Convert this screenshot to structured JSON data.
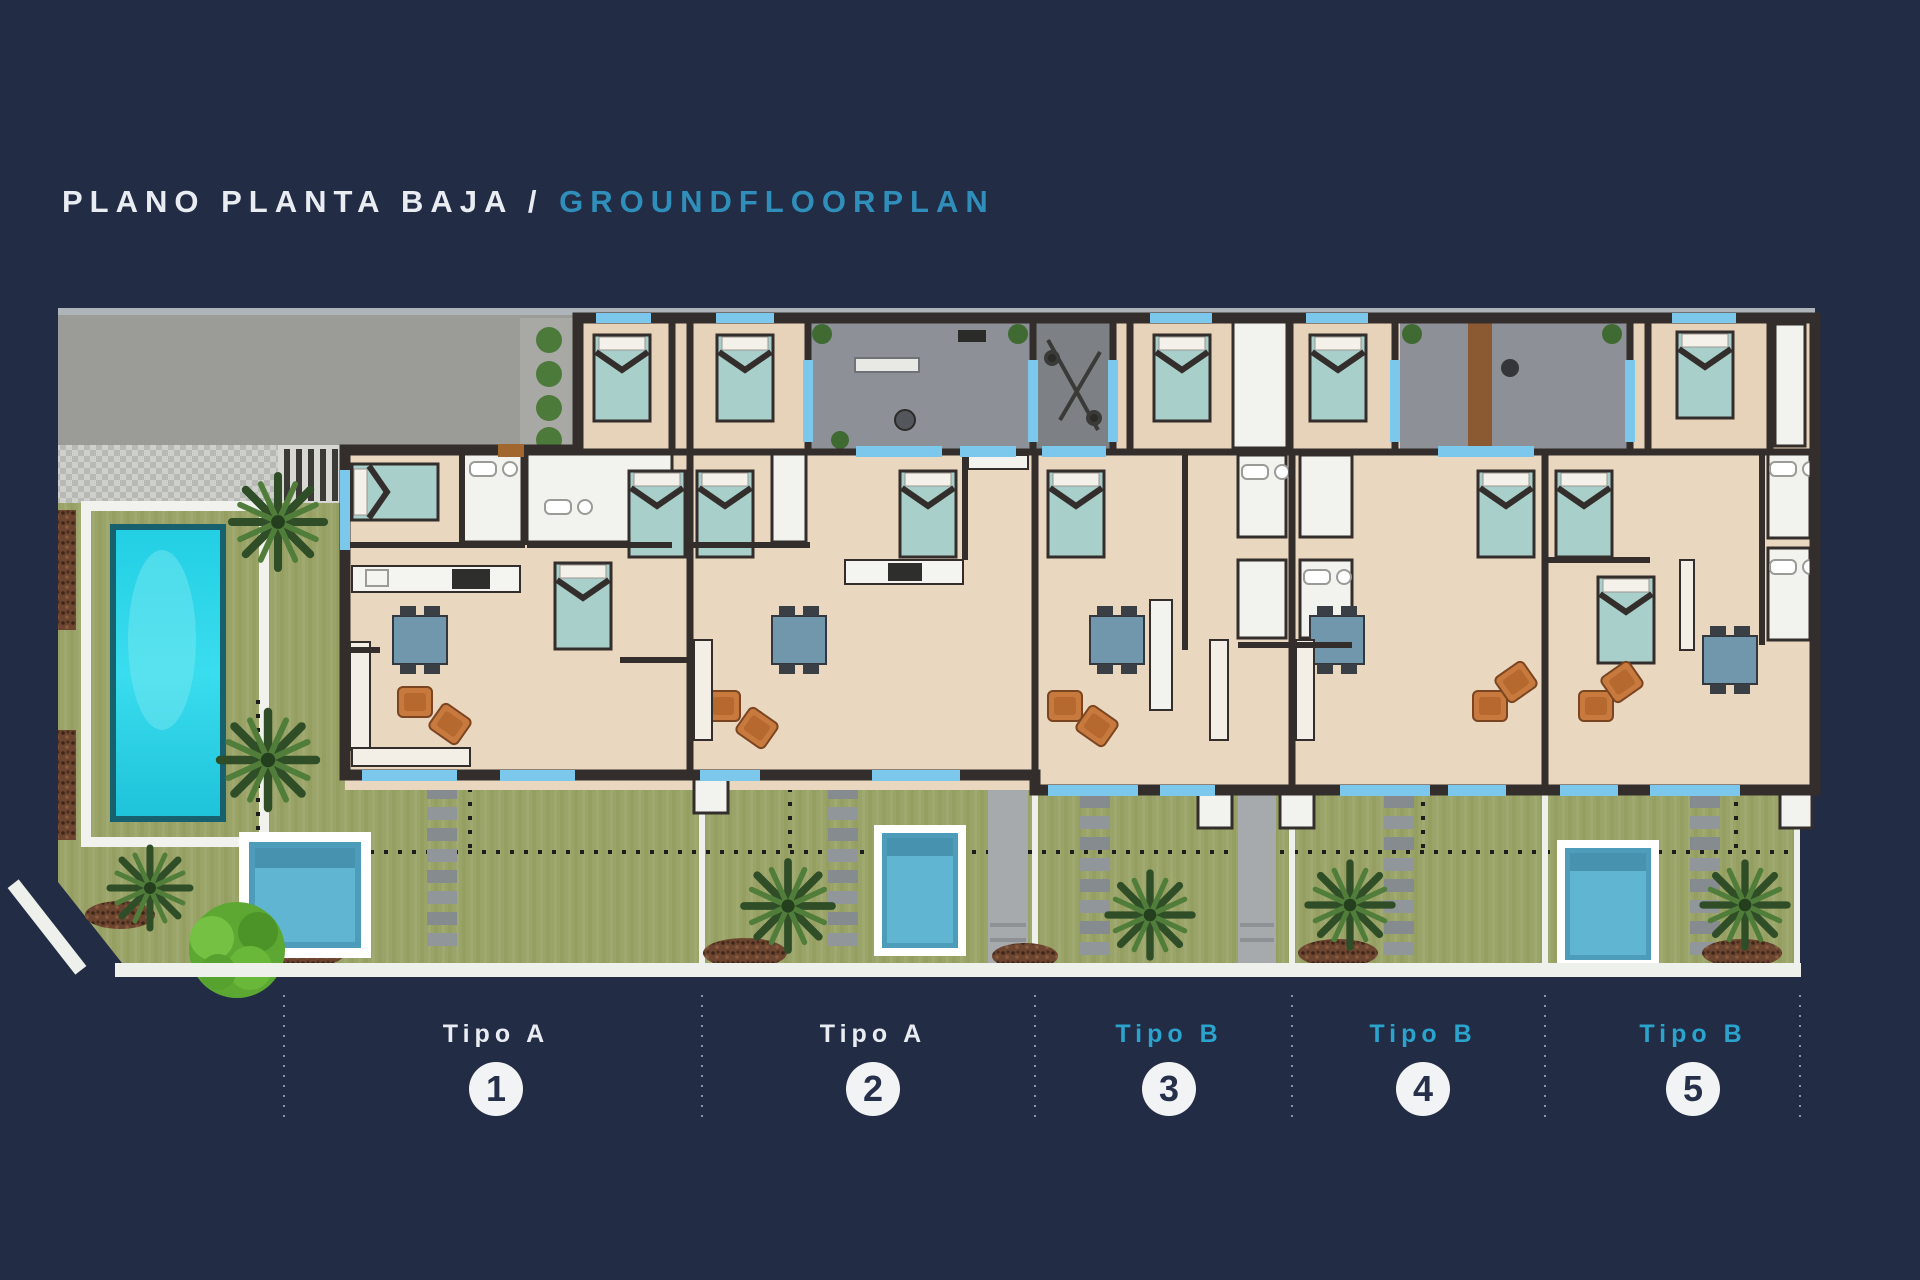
{
  "title": {
    "spanish": "PLANO PLANTA  BAJA",
    "separator": " / ",
    "english": "GROUNDFLOORPLAN"
  },
  "units": [
    {
      "type_label": "Tipo A",
      "number": "1",
      "label_color": "#e9edf2"
    },
    {
      "type_label": "Tipo A",
      "number": "2",
      "label_color": "#e9edf2"
    },
    {
      "type_label": "Tipo B",
      "number": "3",
      "label_color": "#2aa3cd"
    },
    {
      "type_label": "Tipo B",
      "number": "4",
      "label_color": "#2aa3cd"
    },
    {
      "type_label": "Tipo B",
      "number": "5",
      "label_color": "#2aa3cd"
    }
  ],
  "colors": {
    "background": "#222c45",
    "title_accent": "#2f8fba",
    "tipo_b_accent": "#2aa3cd",
    "wall": "#332e2b",
    "floor": "#e7d2ba",
    "window": "#7cc8ec",
    "patio": "#8d9096",
    "driveway": "#9b9b97",
    "garden": "#9aa468",
    "communal_pool": "#27d3e8",
    "plunge_pool": "#5fb5d2",
    "circle_badge": "#f2f3f4"
  }
}
